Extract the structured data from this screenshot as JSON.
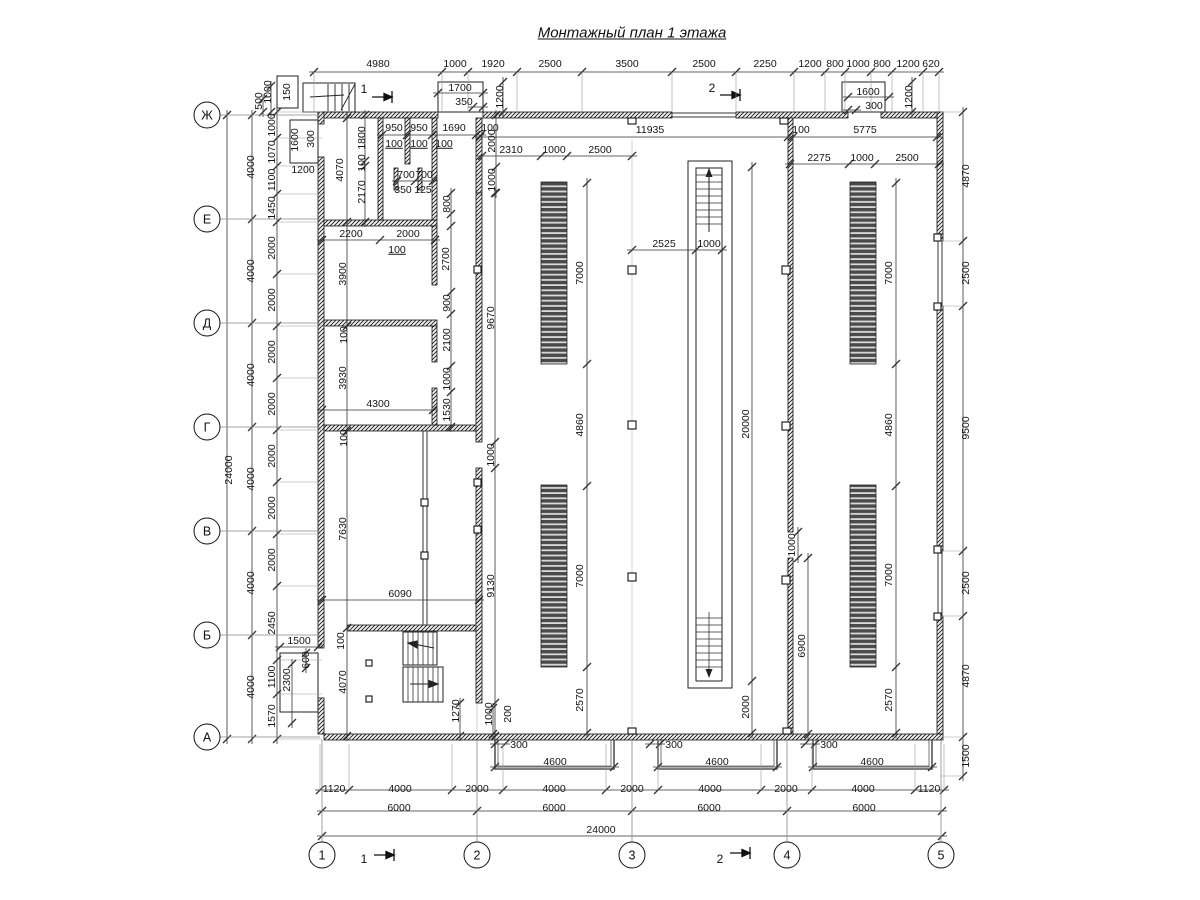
{
  "title": "Монтажный план 1 этажа",
  "axes_left": [
    {
      "label": "Ж",
      "y": 115
    },
    {
      "label": "Е",
      "y": 219
    },
    {
      "label": "Д",
      "y": 323
    },
    {
      "label": "Г",
      "y": 427
    },
    {
      "label": "В",
      "y": 531
    },
    {
      "label": "Б",
      "y": 635
    },
    {
      "label": "А",
      "y": 737
    }
  ],
  "axes_bottom": [
    {
      "label": "1",
      "x": 322
    },
    {
      "label": "2",
      "x": 477
    },
    {
      "label": "3",
      "x": 632
    },
    {
      "label": "4",
      "x": 787
    },
    {
      "label": "5",
      "x": 941
    }
  ],
  "section_marks": [
    {
      "label": "1",
      "x": 364,
      "y": 89
    },
    {
      "label": "2",
      "x": 712,
      "y": 88
    },
    {
      "label": "1",
      "x": 364,
      "y": 859
    },
    {
      "label": "2",
      "x": 720,
      "y": 859
    }
  ],
  "colors": {
    "wall": "#111111",
    "dim_line": "#333333",
    "axis_line": "#888888",
    "bar_fill": "#4a4a4a"
  },
  "dims": [
    {
      "t": "4980",
      "x": 378,
      "y": 64
    },
    {
      "t": "1000",
      "x": 455,
      "y": 64
    },
    {
      "t": "1920",
      "x": 493,
      "y": 64
    },
    {
      "t": "2500",
      "x": 550,
      "y": 64
    },
    {
      "t": "3500",
      "x": 627,
      "y": 64
    },
    {
      "t": "2500",
      "x": 704,
      "y": 64
    },
    {
      "t": "2250",
      "x": 765,
      "y": 64
    },
    {
      "t": "1200",
      "x": 810,
      "y": 64
    },
    {
      "t": "800",
      "x": 835,
      "y": 64
    },
    {
      "t": "1000",
      "x": 858,
      "y": 64
    },
    {
      "t": "800",
      "x": 882,
      "y": 64
    },
    {
      "t": "1200",
      "x": 908,
      "y": 64
    },
    {
      "t": "620",
      "x": 931,
      "y": 64
    },
    {
      "t": "1700",
      "x": 460,
      "y": 88
    },
    {
      "t": "350",
      "x": 464,
      "y": 102
    },
    {
      "t": "1200",
      "x": 500,
      "y": 97,
      "r": 1
    },
    {
      "t": "1600",
      "x": 868,
      "y": 92
    },
    {
      "t": "300",
      "x": 874,
      "y": 106
    },
    {
      "t": "1200",
      "x": 909,
      "y": 97,
      "r": 1
    },
    {
      "t": "150",
      "x": 287,
      "y": 92,
      "r": 1
    },
    {
      "t": "500",
      "x": 259,
      "y": 101,
      "r": 1
    },
    {
      "t": "1000",
      "x": 268,
      "y": 92,
      "r": 1
    },
    {
      "t": "1600",
      "x": 295,
      "y": 140,
      "r": 1
    },
    {
      "t": "300",
      "x": 311,
      "y": 139,
      "r": 1
    },
    {
      "t": "1200",
      "x": 303,
      "y": 170
    },
    {
      "t": "950",
      "x": 394,
      "y": 128
    },
    {
      "t": "950",
      "x": 419,
      "y": 128
    },
    {
      "t": "1690",
      "x": 454,
      "y": 128
    },
    {
      "t": "100",
      "x": 490,
      "y": 128
    },
    {
      "t": "100",
      "x": 394,
      "y": 144,
      "u": 1
    },
    {
      "t": "100",
      "x": 419,
      "y": 144,
      "u": 1
    },
    {
      "t": "100",
      "x": 444,
      "y": 144,
      "u": 1
    },
    {
      "t": "700",
      "x": 406,
      "y": 175
    },
    {
      "t": "700",
      "x": 424,
      "y": 175
    },
    {
      "t": "350",
      "x": 403,
      "y": 190
    },
    {
      "t": "125",
      "x": 423,
      "y": 190
    },
    {
      "t": "1800",
      "x": 362,
      "y": 138,
      "r": 1
    },
    {
      "t": "100",
      "x": 362,
      "y": 163,
      "r": 1
    },
    {
      "t": "2170",
      "x": 362,
      "y": 192,
      "r": 1
    },
    {
      "t": "4070",
      "x": 340,
      "y": 170,
      "r": 1
    },
    {
      "t": "800",
      "x": 447,
      "y": 204,
      "r": 1
    },
    {
      "t": "2700",
      "x": 446,
      "y": 259,
      "r": 1
    },
    {
      "t": "900",
      "x": 447,
      "y": 303,
      "r": 1
    },
    {
      "t": "2100",
      "x": 447,
      "y": 340,
      "r": 1
    },
    {
      "t": "1000",
      "x": 447,
      "y": 379,
      "r": 1
    },
    {
      "t": "1530",
      "x": 447,
      "y": 410,
      "r": 1
    },
    {
      "t": "2000",
      "x": 492,
      "y": 141,
      "r": 1
    },
    {
      "t": "1000",
      "x": 492,
      "y": 180,
      "r": 1
    },
    {
      "t": "3900",
      "x": 343,
      "y": 274,
      "r": 1
    },
    {
      "t": "100",
      "x": 344,
      "y": 335,
      "r": 1
    },
    {
      "t": "3930",
      "x": 343,
      "y": 378,
      "r": 1
    },
    {
      "t": "100",
      "x": 344,
      "y": 438,
      "r": 1
    },
    {
      "t": "7630",
      "x": 343,
      "y": 529,
      "r": 1
    },
    {
      "t": "100",
      "x": 341,
      "y": 641,
      "r": 1
    },
    {
      "t": "4070",
      "x": 343,
      "y": 682,
      "r": 1
    },
    {
      "t": "9670",
      "x": 491,
      "y": 318,
      "r": 1
    },
    {
      "t": "1000",
      "x": 491,
      "y": 455,
      "r": 1
    },
    {
      "t": "9130",
      "x": 491,
      "y": 586,
      "r": 1
    },
    {
      "t": "2200",
      "x": 351,
      "y": 234
    },
    {
      "t": "2000",
      "x": 408,
      "y": 234
    },
    {
      "t": "100",
      "x": 397,
      "y": 250,
      "u": 1
    },
    {
      "t": "4300",
      "x": 378,
      "y": 404
    },
    {
      "t": "6090",
      "x": 400,
      "y": 594
    },
    {
      "t": "1500",
      "x": 299,
      "y": 641
    },
    {
      "t": "600",
      "x": 306,
      "y": 660,
      "r": 1
    },
    {
      "t": "2300",
      "x": 287,
      "y": 680,
      "r": 1
    },
    {
      "t": "1270",
      "x": 456,
      "y": 711,
      "r": 1
    },
    {
      "t": "1000",
      "x": 489,
      "y": 714,
      "r": 1
    },
    {
      "t": "200",
      "x": 508,
      "y": 714,
      "r": 1
    },
    {
      "t": "300",
      "x": 519,
      "y": 745
    },
    {
      "t": "300",
      "x": 674,
      "y": 745
    },
    {
      "t": "300",
      "x": 829,
      "y": 745
    },
    {
      "t": "11935",
      "x": 650,
      "y": 130
    },
    {
      "t": "100",
      "x": 801,
      "y": 130
    },
    {
      "t": "5775",
      "x": 865,
      "y": 130
    },
    {
      "t": "2310",
      "x": 511,
      "y": 150
    },
    {
      "t": "1000",
      "x": 554,
      "y": 150
    },
    {
      "t": "2500",
      "x": 600,
      "y": 150
    },
    {
      "t": "2275",
      "x": 819,
      "y": 158
    },
    {
      "t": "1000",
      "x": 862,
      "y": 158
    },
    {
      "t": "2500",
      "x": 907,
      "y": 158
    },
    {
      "t": "2525",
      "x": 664,
      "y": 244
    },
    {
      "t": "1000",
      "x": 709,
      "y": 244
    },
    {
      "t": "7000",
      "x": 580,
      "y": 273,
      "r": 1
    },
    {
      "t": "4860",
      "x": 580,
      "y": 425,
      "r": 1
    },
    {
      "t": "7000",
      "x": 580,
      "y": 576,
      "r": 1
    },
    {
      "t": "2570",
      "x": 580,
      "y": 700,
      "r": 1
    },
    {
      "t": "7000",
      "x": 889,
      "y": 273,
      "r": 1
    },
    {
      "t": "4860",
      "x": 889,
      "y": 425,
      "r": 1
    },
    {
      "t": "7000",
      "x": 889,
      "y": 575,
      "r": 1
    },
    {
      "t": "2570",
      "x": 889,
      "y": 700,
      "r": 1
    },
    {
      "t": "20000",
      "x": 746,
      "y": 424,
      "r": 1
    },
    {
      "t": "2000",
      "x": 746,
      "y": 707,
      "r": 1
    },
    {
      "t": "6900",
      "x": 802,
      "y": 646,
      "r": 1
    },
    {
      "t": "1000",
      "x": 792,
      "y": 545,
      "r": 1
    },
    {
      "t": "4600",
      "x": 555,
      "y": 762
    },
    {
      "t": "4600",
      "x": 717,
      "y": 762
    },
    {
      "t": "4600",
      "x": 872,
      "y": 762
    },
    {
      "t": "4870",
      "x": 966,
      "y": 176,
      "r": 1
    },
    {
      "t": "2500",
      "x": 966,
      "y": 273,
      "r": 1
    },
    {
      "t": "9500",
      "x": 966,
      "y": 428,
      "r": 1
    },
    {
      "t": "2500",
      "x": 966,
      "y": 583,
      "r": 1
    },
    {
      "t": "4870",
      "x": 966,
      "y": 676,
      "r": 1
    },
    {
      "t": "1500",
      "x": 966,
      "y": 756,
      "r": 1
    },
    {
      "t": "24000",
      "x": 229,
      "y": 470,
      "r": 1
    },
    {
      "t": "4000",
      "x": 251,
      "y": 167,
      "r": 1
    },
    {
      "t": "4000",
      "x": 251,
      "y": 271,
      "r": 1
    },
    {
      "t": "4000",
      "x": 251,
      "y": 375,
      "r": 1
    },
    {
      "t": "4000",
      "x": 251,
      "y": 479,
      "r": 1
    },
    {
      "t": "4000",
      "x": 251,
      "y": 583,
      "r": 1
    },
    {
      "t": "4000",
      "x": 251,
      "y": 687,
      "r": 1
    },
    {
      "t": "1000",
      "x": 272,
      "y": 125,
      "r": 1
    },
    {
      "t": "1070",
      "x": 272,
      "y": 152,
      "r": 1
    },
    {
      "t": "1100",
      "x": 272,
      "y": 180,
      "r": 1
    },
    {
      "t": "1450",
      "x": 272,
      "y": 208,
      "r": 1
    },
    {
      "t": "2000",
      "x": 272,
      "y": 248,
      "r": 1
    },
    {
      "t": "2000",
      "x": 272,
      "y": 300,
      "r": 1
    },
    {
      "t": "2000",
      "x": 272,
      "y": 352,
      "r": 1
    },
    {
      "t": "2000",
      "x": 272,
      "y": 404,
      "r": 1
    },
    {
      "t": "2000",
      "x": 272,
      "y": 456,
      "r": 1
    },
    {
      "t": "2000",
      "x": 272,
      "y": 508,
      "r": 1
    },
    {
      "t": "2000",
      "x": 272,
      "y": 560,
      "r": 1
    },
    {
      "t": "2450",
      "x": 272,
      "y": 623,
      "r": 1
    },
    {
      "t": "1100",
      "x": 272,
      "y": 677,
      "r": 1
    },
    {
      "t": "1570",
      "x": 272,
      "y": 716,
      "r": 1
    },
    {
      "t": "1120",
      "x": 334,
      "y": 789
    },
    {
      "t": "4000",
      "x": 400,
      "y": 789
    },
    {
      "t": "2000",
      "x": 477,
      "y": 789
    },
    {
      "t": "4000",
      "x": 554,
      "y": 789
    },
    {
      "t": "2000",
      "x": 632,
      "y": 789
    },
    {
      "t": "4000",
      "x": 710,
      "y": 789
    },
    {
      "t": "2000",
      "x": 786,
      "y": 789
    },
    {
      "t": "4000",
      "x": 863,
      "y": 789
    },
    {
      "t": "1120",
      "x": 929,
      "y": 789
    },
    {
      "t": "6000",
      "x": 399,
      "y": 808
    },
    {
      "t": "6000",
      "x": 554,
      "y": 808
    },
    {
      "t": "6000",
      "x": 709,
      "y": 808
    },
    {
      "t": "6000",
      "x": 864,
      "y": 808
    },
    {
      "t": "24000",
      "x": 601,
      "y": 830
    }
  ]
}
